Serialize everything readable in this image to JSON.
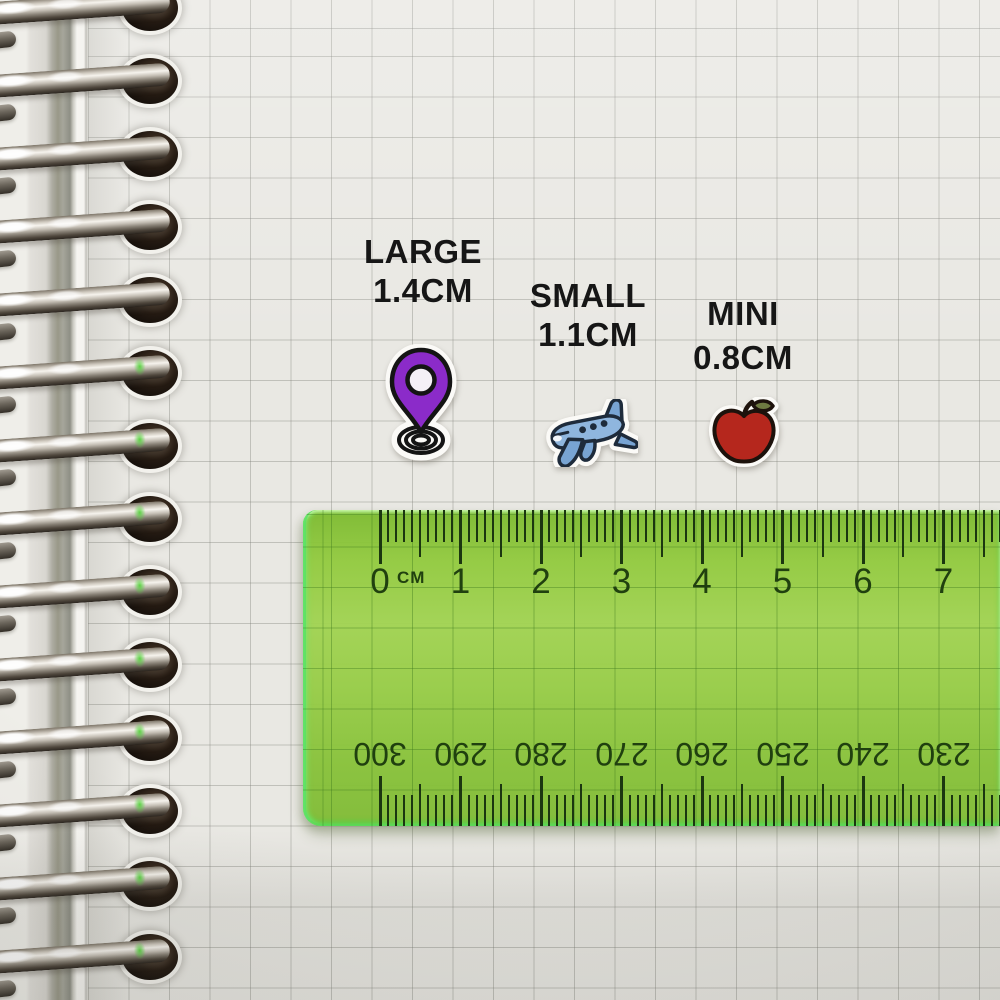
{
  "notebook": {
    "paper_color": "#e9e8e3",
    "grid_color": "#b9b8b2",
    "ring_count": 14
  },
  "labels": {
    "large": {
      "name": "LARGE",
      "size": "1.4CM"
    },
    "small": {
      "name": "SMALL",
      "size": "1.1CM"
    },
    "mini": {
      "name": "MINI",
      "size": "0.8CM"
    }
  },
  "stickers": {
    "pin": {
      "kind": "location-pin",
      "fill": "#8b2bc9"
    },
    "plane": {
      "kind": "airplane",
      "fill": "#7fa9d6"
    },
    "apple": {
      "kind": "apple",
      "fill": "#b5271d"
    }
  },
  "ruler": {
    "unit_label": "CM",
    "top_numbers": [
      0,
      1,
      2,
      3,
      4,
      5,
      6,
      7
    ],
    "bottom_numbers": [
      300,
      290,
      280,
      270,
      260,
      250,
      240,
      230
    ],
    "body_color": "#92c843",
    "mark_color": "#1b3610"
  }
}
